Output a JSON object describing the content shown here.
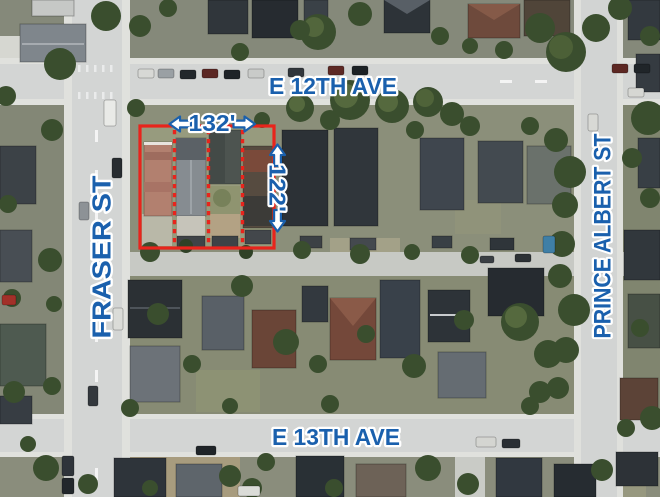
{
  "map": {
    "view": "satellite",
    "streets": {
      "top": {
        "label": "E 12TH AVE"
      },
      "bottom": {
        "label": "E 13TH AVE"
      },
      "left": {
        "label": "FRASER ST"
      },
      "right": {
        "label": "PRINCE ALBERT ST"
      }
    },
    "parcel": {
      "frontage_label": "132'",
      "depth_label": "122'",
      "lot_count": 4,
      "outline_color": "#e8241c"
    },
    "colors": {
      "label_text": "#1a60ad",
      "label_halo": "#ffffff"
    }
  }
}
